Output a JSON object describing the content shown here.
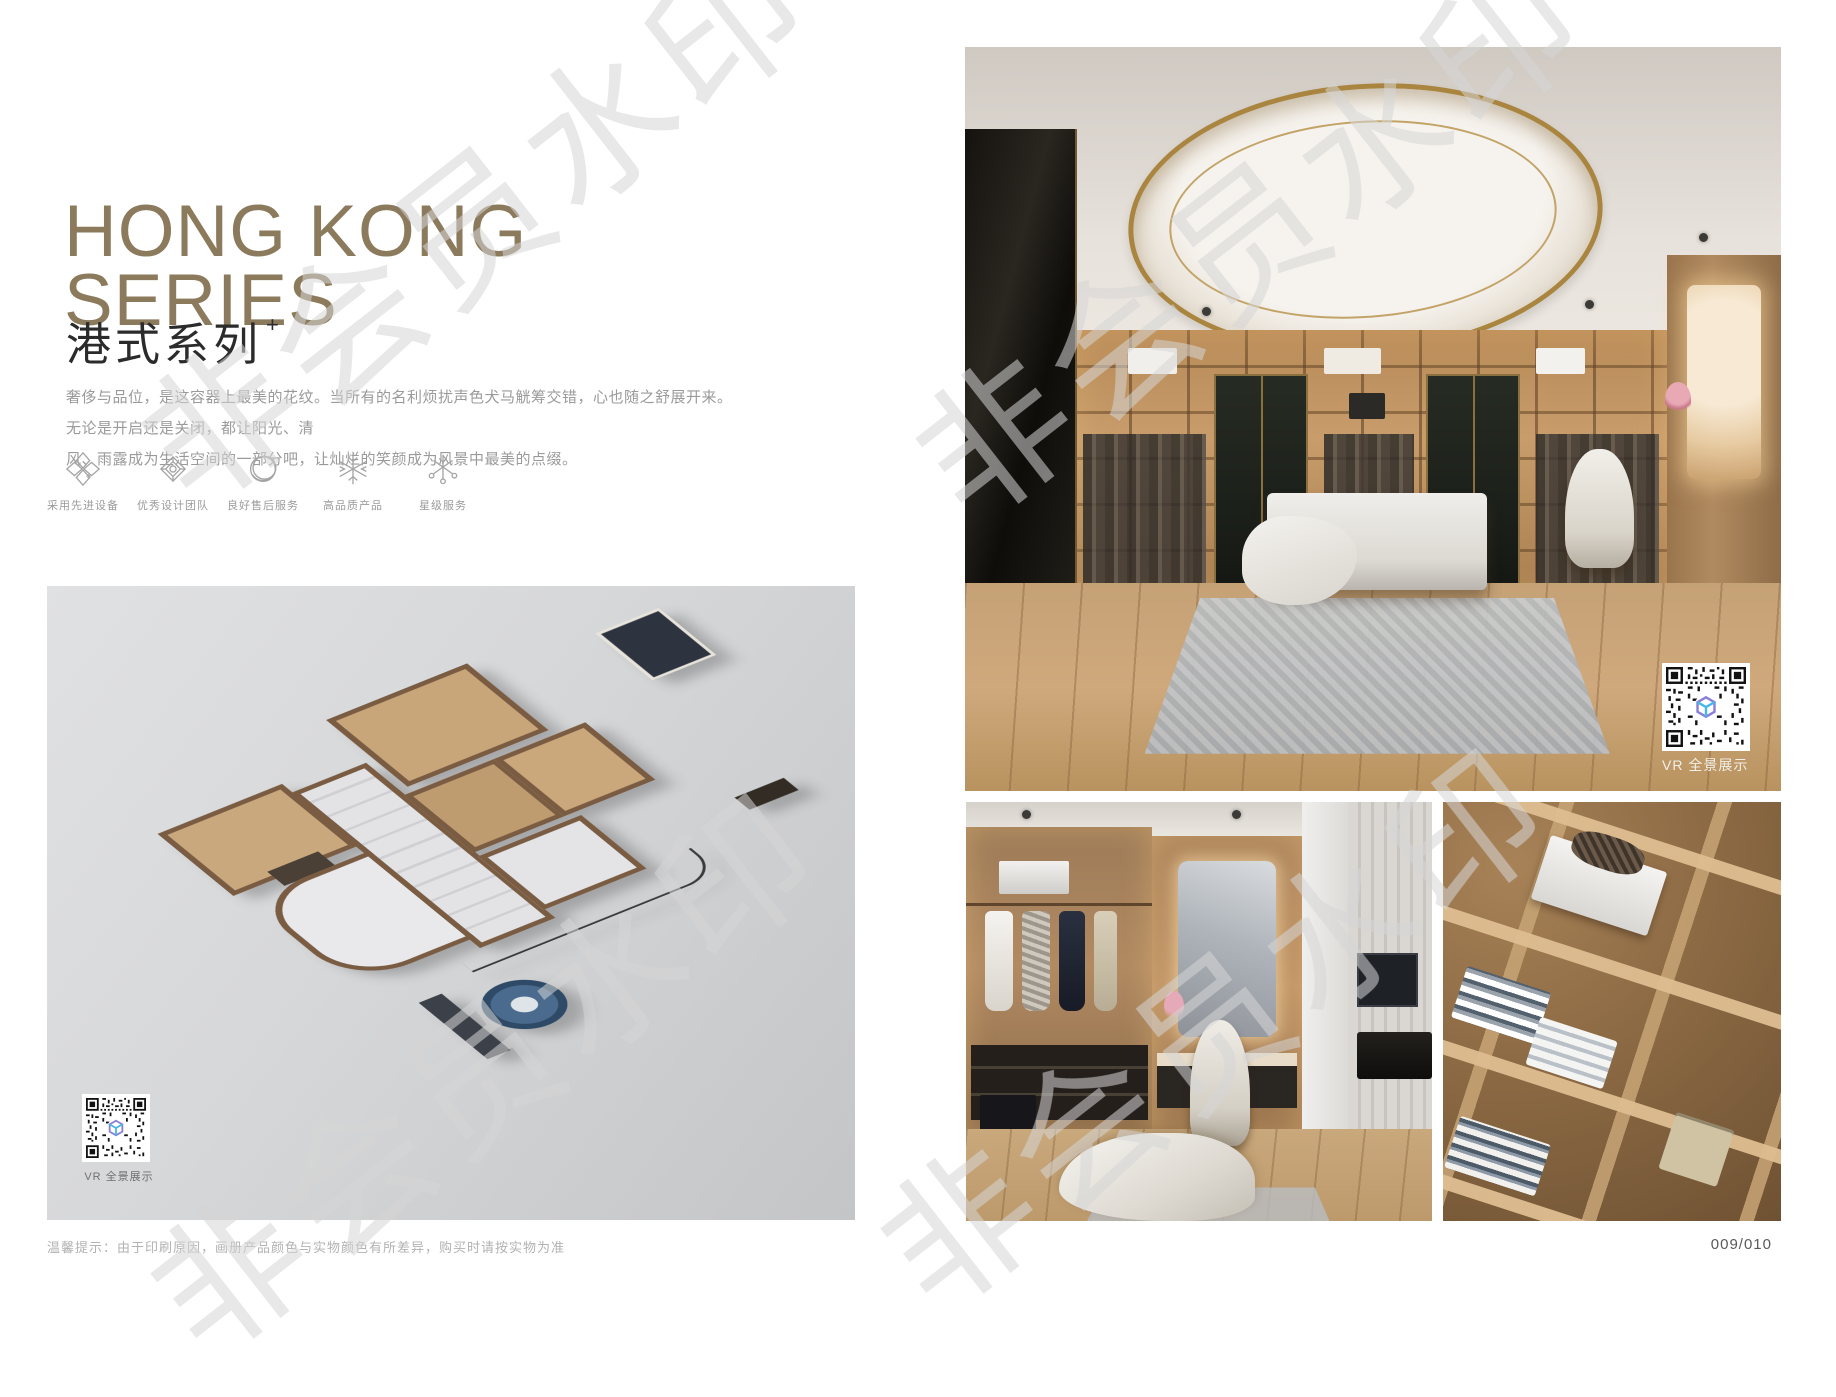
{
  "header": {
    "title_line1": "HONG KONG",
    "title_line2": "SERIES",
    "subtitle": "港式系列",
    "subtitle_superscript": "+",
    "description_line1": "奢侈与品位，是这容器上最美的花纹。当所有的名利烦扰声色犬马觥筹交错，心也随之舒展开来。无论是开启还是关闭，都让阳光、清",
    "description_line2": "风、雨露成为生活空间的一部分吧，让灿烂的笑颜成为风景中最美的点缀。"
  },
  "features": [
    {
      "icon": "quad-diamond-icon",
      "label": "采用先进设备"
    },
    {
      "icon": "diamond-rosette-icon",
      "label": "优秀设计团队"
    },
    {
      "icon": "double-ring-icon",
      "label": "良好售后服务"
    },
    {
      "icon": "snowflake-icon",
      "label": "高品质产品"
    },
    {
      "icon": "star-snowflake-icon",
      "label": "星级服务"
    }
  ],
  "floorplan_card": {
    "vr_badge": "VR 全景展示"
  },
  "main_photo": {
    "vr_badge": "VR 全景展示"
  },
  "footer": {
    "disclaimer": "温馨提示：由于印刷原因，画册产品颜色与实物颜色有所差异，购买时请按实物为准",
    "page_number": "009/010"
  },
  "watermark": {
    "text": "非会员水印"
  },
  "colors": {
    "title_brown": "#8c7a5c",
    "accent_gold": "#a9853f",
    "panel_grey": "#d6d7d9",
    "text_grey": "#9a9a9a"
  }
}
